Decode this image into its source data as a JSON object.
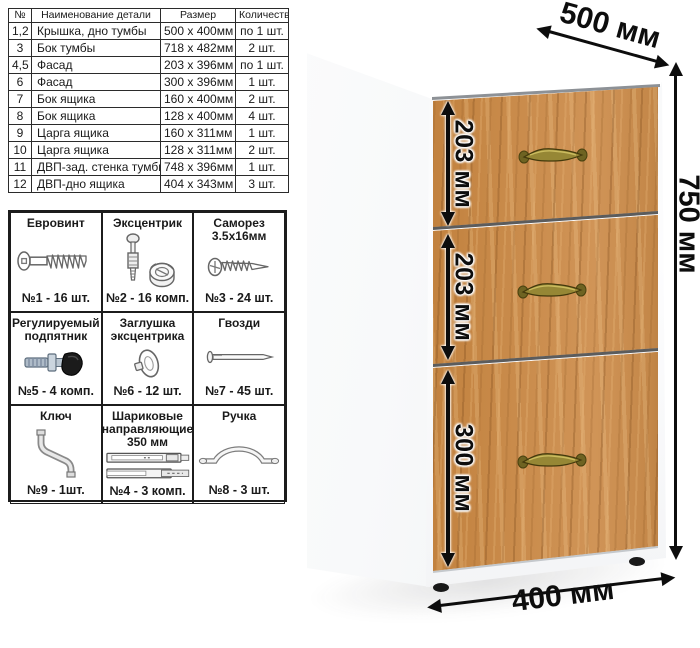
{
  "parts_table": {
    "headers": [
      "№",
      "Наименование детали",
      "Размер",
      "Количество"
    ],
    "rows": [
      {
        "num": "1,2",
        "name": "Крышка, дно тумбы",
        "size": "500 x 400мм",
        "qty": "по 1 шт."
      },
      {
        "num": "3",
        "name": "Бок тумбы",
        "size": "718 x 482мм",
        "qty": "2 шт."
      },
      {
        "num": "4,5",
        "name": "Фасад",
        "size": "203 x 396мм",
        "qty": "по 1 шт."
      },
      {
        "num": "6",
        "name": "Фасад",
        "size": "300 x 396мм",
        "qty": "1 шт."
      },
      {
        "num": "7",
        "name": "Бок ящика",
        "size": "160 x 400мм",
        "qty": "2 шт."
      },
      {
        "num": "8",
        "name": "Бок ящика",
        "size": "128 x 400мм",
        "qty": "4 шт."
      },
      {
        "num": "9",
        "name": "Царга ящика",
        "size": "160 x 311мм",
        "qty": "1 шт."
      },
      {
        "num": "10",
        "name": "Царга ящика",
        "size": "128 x 311мм",
        "qty": "2 шт."
      },
      {
        "num": "11",
        "name": "ДВП-зад. стенка тумбы",
        "size": "748 x 396мм",
        "qty": "1 шт."
      },
      {
        "num": "12",
        "name": "ДВП-дно ящика",
        "size": "404 x 343мм",
        "qty": "3 шт."
      }
    ]
  },
  "hardware": {
    "items": [
      {
        "title": "Евровинт",
        "qty": "№1 - 16 шт.",
        "icon": "euro-screw"
      },
      {
        "title": "Эксцентрик",
        "qty": "№2 - 16 комп.",
        "icon": "cam-lock"
      },
      {
        "title": "Саморез 3.5х16мм",
        "qty": "№3 - 24 шт.",
        "icon": "self-tapping-screw"
      },
      {
        "title": "Регулируемый подпятник",
        "qty": "№5 - 4 комп.",
        "icon": "adjustable-foot"
      },
      {
        "title": "Заглушка эксцентрика",
        "qty": "№6 - 12 шт.",
        "icon": "cam-cover"
      },
      {
        "title": "Гвозди",
        "qty": "№7 - 45 шт.",
        "icon": "nail"
      },
      {
        "title": "Ключ",
        "qty": "№9 - 1шт.",
        "icon": "key"
      },
      {
        "title": "Шариковые направляющие 350 мм",
        "qty": "№4 - 3 комп.",
        "icon": "ball-slides"
      },
      {
        "title": "Ручка",
        "qty": "№8 - 3 шт.",
        "icon": "handle"
      }
    ]
  },
  "dimensions": {
    "depth": "500 мм",
    "height": "750 мм",
    "width": "400 мм",
    "drawers": [
      "203 мм",
      "203 мм",
      "300 мм"
    ]
  },
  "colors": {
    "wood": "#c98a4b",
    "handle_brass": "#8f7f2d",
    "arrow": "#0d0d0d",
    "table_border": "#2b2b2b",
    "cabinet_white": "#ffffff"
  }
}
